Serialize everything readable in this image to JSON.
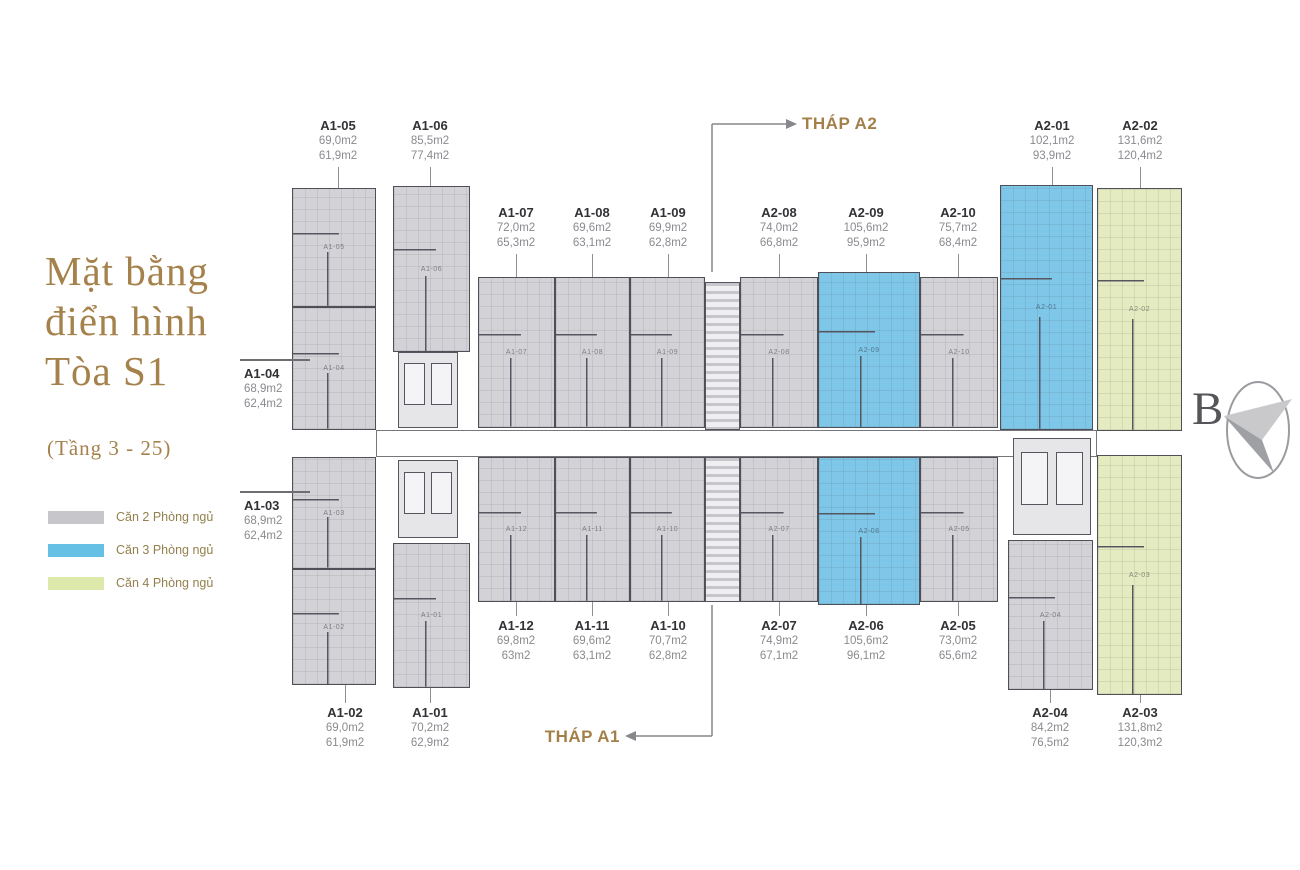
{
  "title": {
    "line1": "Mặt bằng",
    "line2": "điển hình",
    "line3": "Tòa S1",
    "subtitle": "(Tầng 3 - 25)"
  },
  "legend": {
    "items": [
      {
        "label": "Căn 2 Phòng ngủ",
        "color": "#c7c7cb",
        "type": "2br"
      },
      {
        "label": "Căn 3 Phòng ngủ",
        "color": "#66c0e6",
        "type": "3br"
      },
      {
        "label": "Căn 4 Phòng ngủ",
        "color": "#dde8ab",
        "type": "4br"
      }
    ]
  },
  "callouts": {
    "thap_a2": "THÁP A2",
    "thap_a1": "THÁP A1"
  },
  "compass": {
    "letter": "B"
  },
  "plan": {
    "colors": {
      "2br": "#d3d3d7",
      "3br": "#7ec7e9",
      "4br": "#e5ebc0"
    },
    "corridors": [
      {
        "x": 376,
        "y": 430,
        "w": 721,
        "h": 27
      }
    ],
    "cores": [
      {
        "kind": "lift",
        "x": 398,
        "y": 352,
        "w": 60,
        "h": 76
      },
      {
        "kind": "lift",
        "x": 398,
        "y": 460,
        "w": 60,
        "h": 78
      },
      {
        "kind": "stair",
        "x": 705,
        "y": 282,
        "w": 35,
        "h": 148
      },
      {
        "kind": "stair",
        "x": 705,
        "y": 457,
        "w": 35,
        "h": 145
      },
      {
        "kind": "lift",
        "x": 1013,
        "y": 438,
        "w": 78,
        "h": 97
      }
    ],
    "units": [
      {
        "id": "A1-05",
        "type": "2br",
        "area1": "69,0m2",
        "area2": "61,9m2",
        "x": 292,
        "y": 188,
        "w": 84,
        "h": 119,
        "side": "top",
        "lx": 298,
        "ly": 118
      },
      {
        "id": "A1-06",
        "type": "2br",
        "area1": "85,5m2",
        "area2": "77,4m2",
        "x": 393,
        "y": 186,
        "w": 77,
        "h": 166,
        "side": "top",
        "lx": 390,
        "ly": 118
      },
      {
        "id": "A1-07",
        "type": "2br",
        "area1": "72,0m2",
        "area2": "65,3m2",
        "x": 478,
        "y": 277,
        "w": 77,
        "h": 151,
        "side": "top",
        "lx": 476,
        "ly": 205
      },
      {
        "id": "A1-08",
        "type": "2br",
        "area1": "69,6m2",
        "area2": "63,1m2",
        "x": 555,
        "y": 277,
        "w": 75,
        "h": 151,
        "side": "top",
        "lx": 552,
        "ly": 205
      },
      {
        "id": "A1-09",
        "type": "2br",
        "area1": "69,9m2",
        "area2": "62,8m2",
        "x": 630,
        "y": 277,
        "w": 75,
        "h": 151,
        "side": "top",
        "lx": 628,
        "ly": 205
      },
      {
        "id": "A2-08",
        "type": "2br",
        "area1": "74,0m2",
        "area2": "66,8m2",
        "x": 740,
        "y": 277,
        "w": 78,
        "h": 151,
        "side": "top",
        "lx": 739,
        "ly": 205
      },
      {
        "id": "A2-09",
        "type": "3br",
        "area1": "105,6m2",
        "area2": "95,9m2",
        "x": 818,
        "y": 272,
        "w": 102,
        "h": 156,
        "side": "top",
        "lx": 826,
        "ly": 205
      },
      {
        "id": "A2-10",
        "type": "2br",
        "area1": "75,7m2",
        "area2": "68,4m2",
        "x": 920,
        "y": 277,
        "w": 78,
        "h": 151,
        "side": "top",
        "lx": 918,
        "ly": 205
      },
      {
        "id": "A2-01",
        "type": "3br",
        "area1": "102,1m2",
        "area2": "93,9m2",
        "x": 1000,
        "y": 185,
        "w": 93,
        "h": 245,
        "side": "top",
        "lx": 1012,
        "ly": 118
      },
      {
        "id": "A2-02",
        "type": "4br",
        "area1": "131,6m2",
        "area2": "120,4m2",
        "x": 1097,
        "y": 188,
        "w": 85,
        "h": 243,
        "side": "top",
        "lx": 1100,
        "ly": 118
      },
      {
        "id": "A1-04",
        "type": "2br",
        "area1": "68,9m2",
        "area2": "62,4m2",
        "x": 292,
        "y": 307,
        "w": 84,
        "h": 123,
        "side": "left",
        "lx": 244,
        "ly": 366
      },
      {
        "id": "A1-03",
        "type": "2br",
        "area1": "68,9m2",
        "area2": "62,4m2",
        "x": 292,
        "y": 457,
        "w": 84,
        "h": 112,
        "side": "left",
        "lx": 244,
        "ly": 498
      },
      {
        "id": "A1-02",
        "type": "2br",
        "area1": "69,0m2",
        "area2": "61,9m2",
        "x": 292,
        "y": 569,
        "w": 84,
        "h": 116,
        "side": "bottom",
        "lx": 305,
        "ly": 705
      },
      {
        "id": "A1-01",
        "type": "2br",
        "area1": "70,2m2",
        "area2": "62,9m2",
        "x": 393,
        "y": 543,
        "w": 77,
        "h": 145,
        "side": "bottom",
        "lx": 390,
        "ly": 705
      },
      {
        "id": "A1-12",
        "type": "2br",
        "area1": "69,8m2",
        "area2": "63m2",
        "x": 478,
        "y": 457,
        "w": 77,
        "h": 145,
        "side": "bottom",
        "lx": 476,
        "ly": 618
      },
      {
        "id": "A1-11",
        "type": "2br",
        "area1": "69,6m2",
        "area2": "63,1m2",
        "x": 555,
        "y": 457,
        "w": 75,
        "h": 145,
        "side": "bottom",
        "lx": 552,
        "ly": 618
      },
      {
        "id": "A1-10",
        "type": "2br",
        "area1": "70,7m2",
        "area2": "62,8m2",
        "x": 630,
        "y": 457,
        "w": 75,
        "h": 145,
        "side": "bottom",
        "lx": 628,
        "ly": 618
      },
      {
        "id": "A2-07",
        "type": "2br",
        "area1": "74,9m2",
        "area2": "67,1m2",
        "x": 740,
        "y": 457,
        "w": 78,
        "h": 145,
        "side": "bottom",
        "lx": 739,
        "ly": 618
      },
      {
        "id": "A2-06",
        "type": "3br",
        "area1": "105,6m2",
        "area2": "96,1m2",
        "x": 818,
        "y": 457,
        "w": 102,
        "h": 148,
        "side": "bottom",
        "lx": 826,
        "ly": 618
      },
      {
        "id": "A2-05",
        "type": "2br",
        "area1": "73,0m2",
        "area2": "65,6m2",
        "x": 920,
        "y": 457,
        "w": 78,
        "h": 145,
        "side": "bottom",
        "lx": 918,
        "ly": 618
      },
      {
        "id": "A2-04",
        "type": "2br",
        "area1": "84,2m2",
        "area2": "76,5m2",
        "x": 1008,
        "y": 540,
        "w": 85,
        "h": 150,
        "side": "bottom",
        "lx": 1010,
        "ly": 705
      },
      {
        "id": "A2-03",
        "type": "4br",
        "area1": "131,8m2",
        "area2": "120,3m2",
        "x": 1097,
        "y": 455,
        "w": 85,
        "h": 240,
        "side": "bottom",
        "lx": 1100,
        "ly": 705
      }
    ]
  }
}
